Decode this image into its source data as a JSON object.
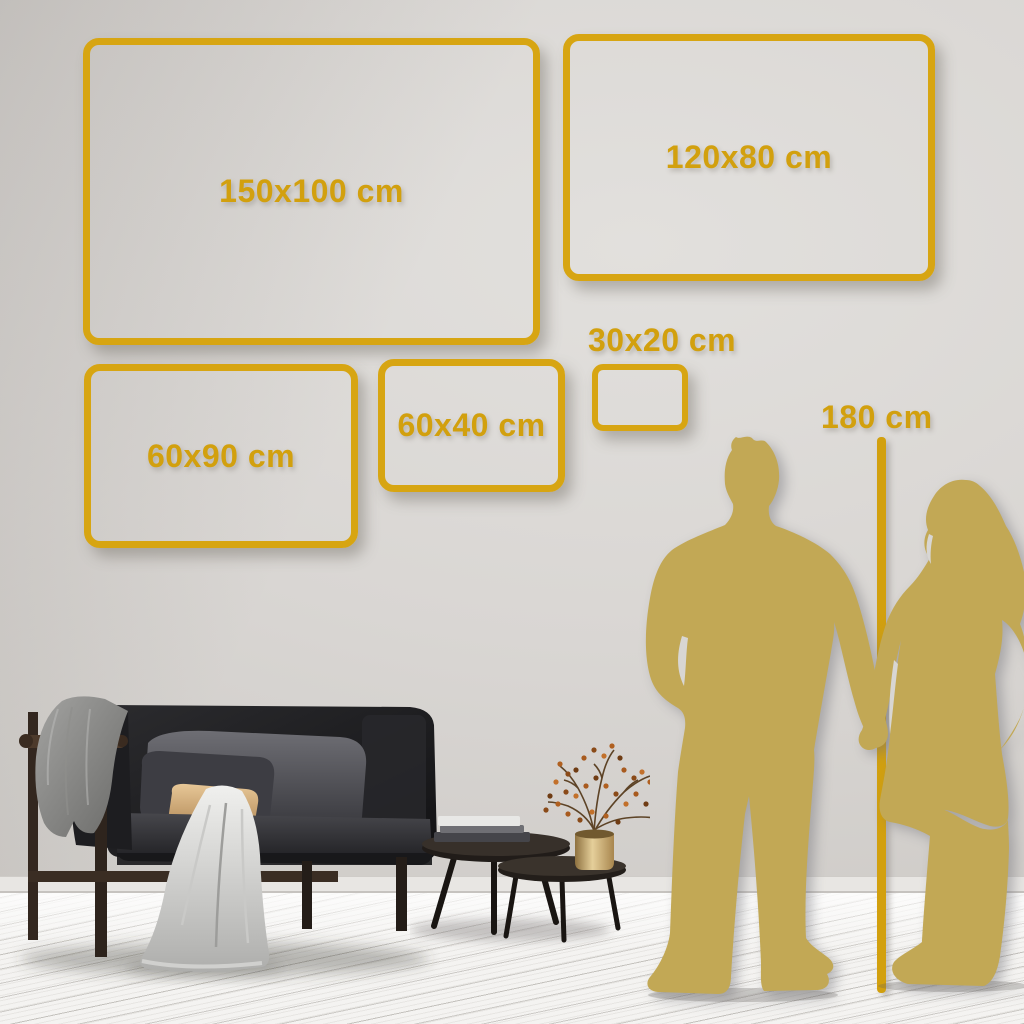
{
  "page": {
    "description": "Wall art size guide mockup in living-room interior",
    "unit": "cm"
  },
  "sizes": {
    "items": [
      {
        "label": "150x100 cm",
        "width_cm": 150,
        "height_cm": 100
      },
      {
        "label": "120x80 cm",
        "width_cm": 120,
        "height_cm": 80
      },
      {
        "label": "60x90 cm",
        "width_cm": 60,
        "height_cm": 90
      },
      {
        "label": "60x40 cm",
        "width_cm": 60,
        "height_cm": 40
      },
      {
        "label": "30x20 cm",
        "width_cm": 30,
        "height_cm": 20
      }
    ]
  },
  "reference": {
    "label": "180 cm",
    "height_cm": 180,
    "figure": "couple-silhouette-holding-hands"
  },
  "colors": {
    "accent_gold": "#D7A512",
    "silhouette_gold": "#C2A855",
    "wall": "#D9D6D3",
    "floor": "#F4F3F1",
    "sofa": "#1c1c1f",
    "tan_pillow": "#C9A172"
  },
  "scene": {
    "elements": [
      "dark-sofa",
      "gray-throw-blanket",
      "light-draped-blanket",
      "tan-pillow",
      "nesting-coffee-tables",
      "book-stack",
      "brass-vase-with-dried-plant",
      "couple-silhouette",
      "height-ruler-line"
    ]
  }
}
